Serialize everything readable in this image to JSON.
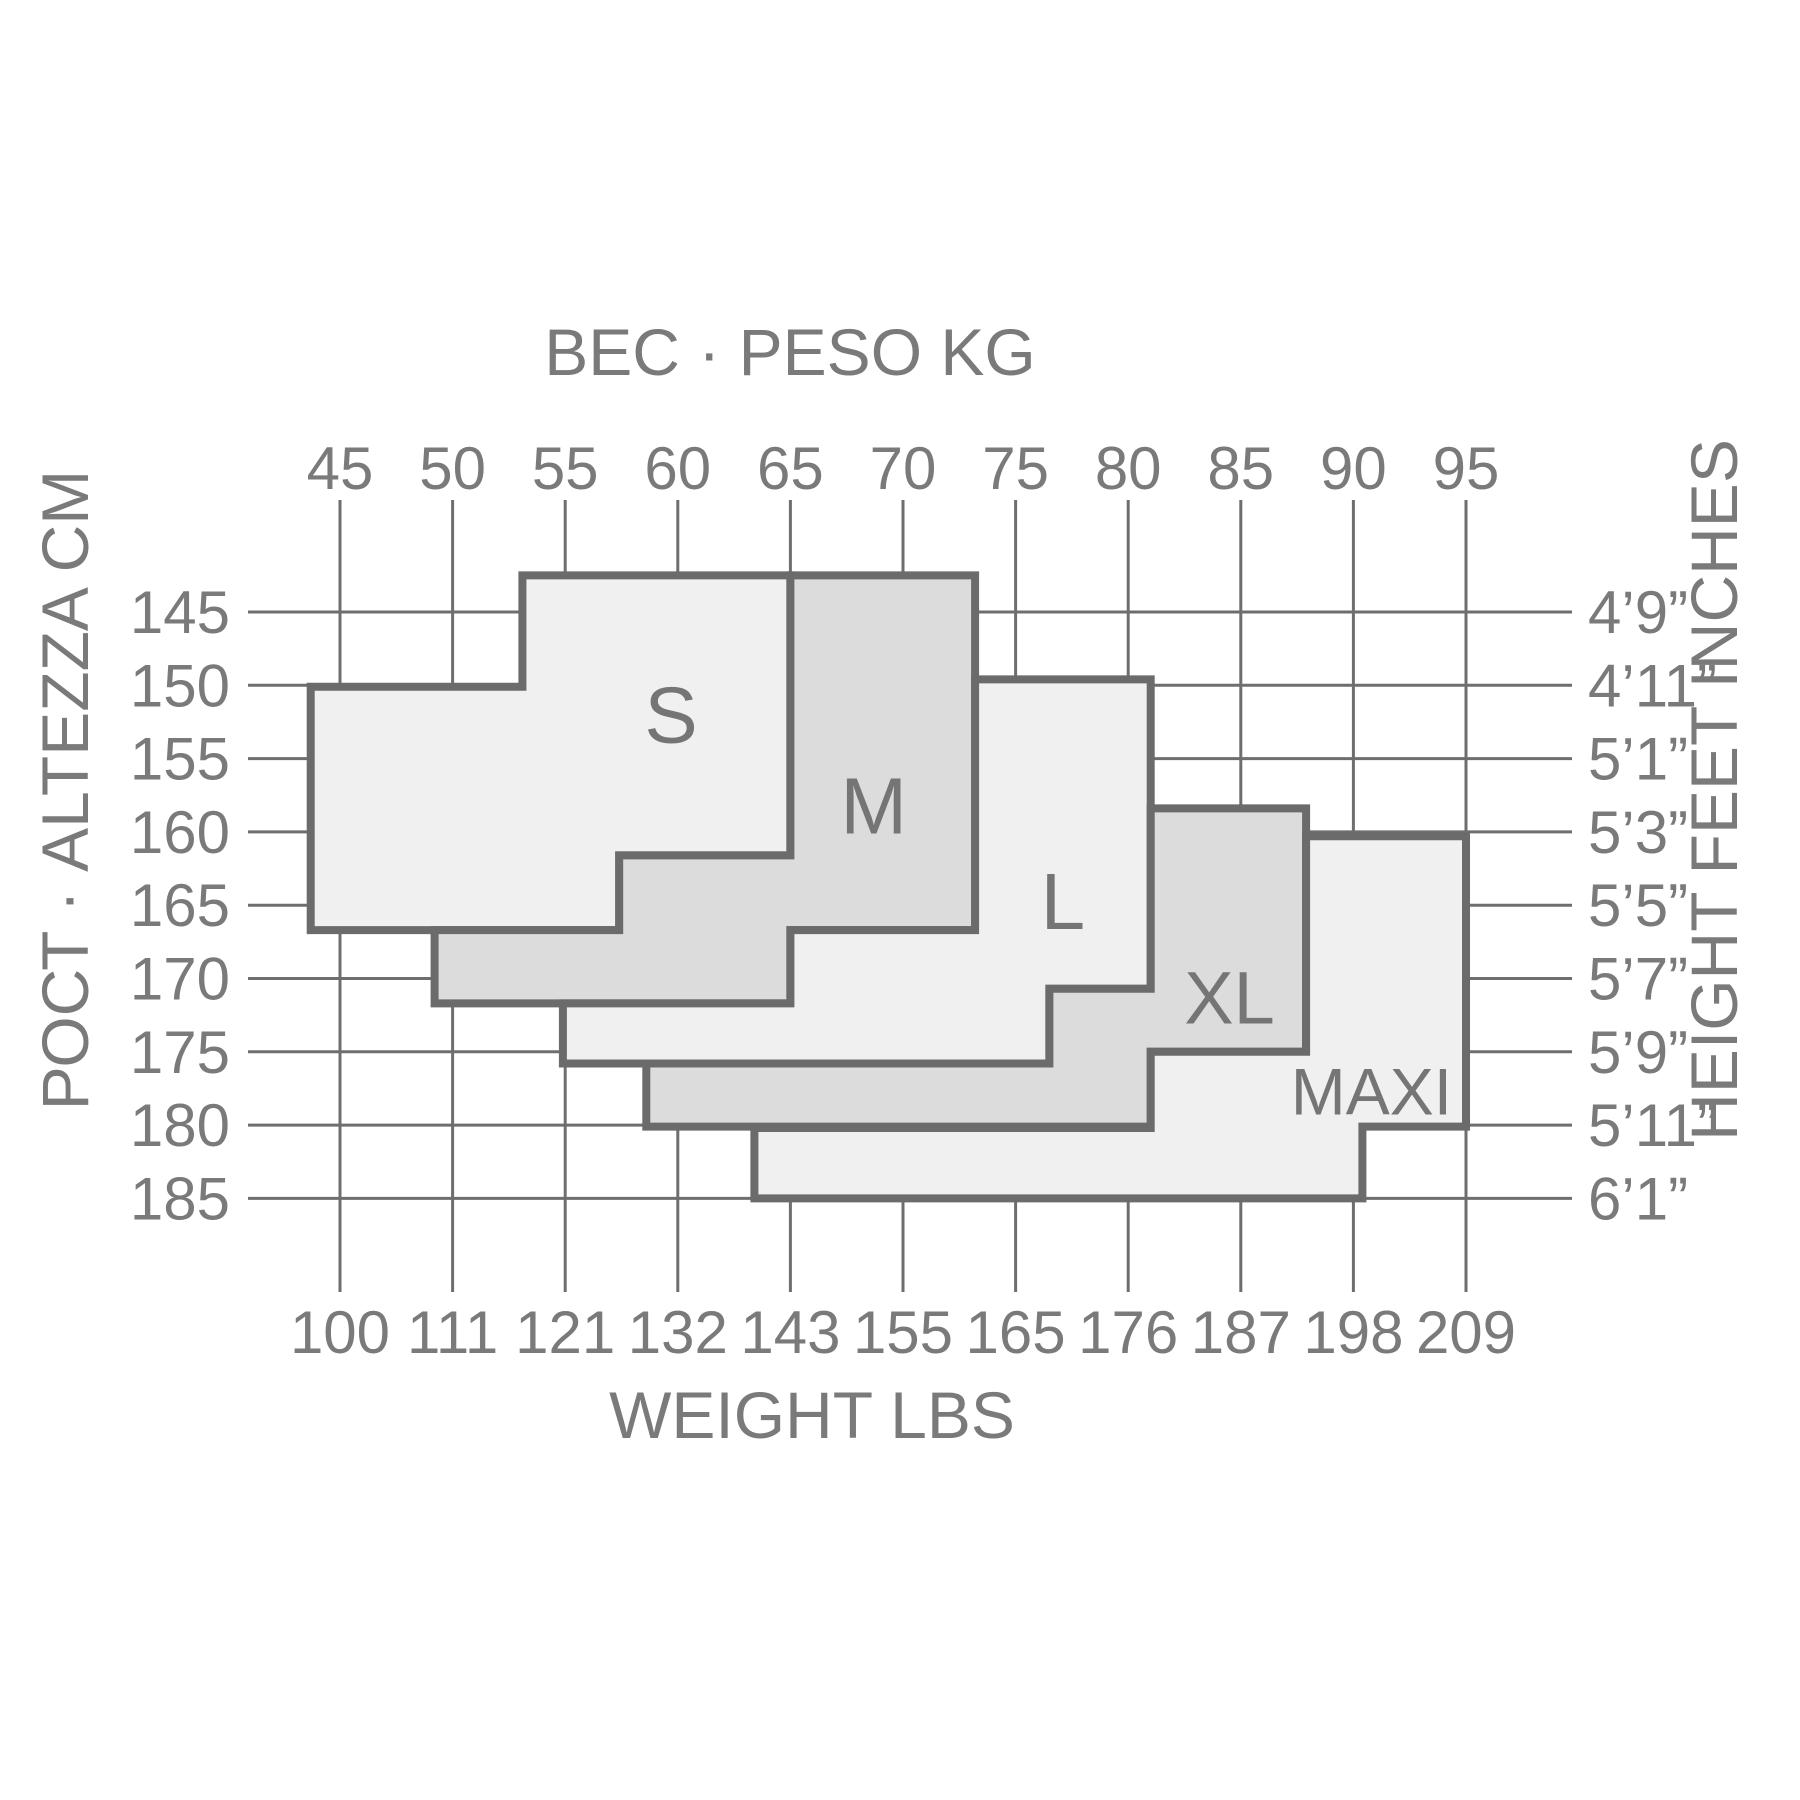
{
  "titles": {
    "top": "ВЕС · PESO KG",
    "bottom": "WEIGHT LBS",
    "left": "РОСТ · ALTEZZA CM",
    "right": "HEIGHT FEET INCHES"
  },
  "colors": {
    "background": "#ffffff",
    "grid_line": "#6e6e6e",
    "region_outline": "#6b6b6b",
    "region_fill_light": "#f0f0f0",
    "region_fill_dark": "#dcdcdc",
    "text": "#7a7a7a",
    "region_label_text": "#757575"
  },
  "chart_data": {
    "type": "area",
    "title": "Size chart: weight vs height size regions (S, M, L, XL, MAXI)",
    "x_axis_top": {
      "label": "ВЕС · PESO KG",
      "ticks": [
        45,
        50,
        55,
        60,
        65,
        70,
        75,
        80,
        85,
        90,
        95
      ]
    },
    "x_axis_bottom": {
      "label": "WEIGHT LBS",
      "ticks": [
        100,
        111,
        121,
        132,
        143,
        155,
        165,
        176,
        187,
        198,
        209
      ]
    },
    "y_axis_left": {
      "label": "РОСТ · ALTEZZA CM",
      "ticks": [
        145,
        150,
        155,
        160,
        165,
        170,
        175,
        180,
        185
      ]
    },
    "y_axis_right": {
      "label": "HEIGHT FEET INCHES",
      "ticks": [
        "4’9”",
        "4’11”",
        "5’1”",
        "5’3”",
        "5’5”",
        "5’7”",
        "5’9”",
        "5’11”",
        "6’1”"
      ]
    },
    "x_range_kg": [
      45,
      95
    ],
    "y_range_cm": [
      145,
      185
    ],
    "grid": true,
    "legend_position": "none",
    "regions": [
      {
        "name": "S",
        "fill": "light",
        "approx_weight_kg": [
          44,
          65
        ],
        "approx_height_cm": [
          142,
          167
        ],
        "label_anchor_kg_cm": [
          59.7,
          152.0
        ],
        "label_font_px": 80,
        "polygon_kg_cm": [
          [
            53.1,
            142.5
          ],
          [
            65,
            142.5
          ],
          [
            65,
            161.6
          ],
          [
            57.4,
            161.6
          ],
          [
            57.4,
            166.7
          ],
          [
            43.7,
            166.7
          ],
          [
            43.7,
            150.1
          ],
          [
            53.1,
            150.1
          ]
        ]
      },
      {
        "name": "M",
        "fill": "dark",
        "approx_weight_kg": [
          49,
          73
        ],
        "approx_height_cm": [
          142,
          172
        ],
        "label_anchor_kg_cm": [
          68.7,
          158.2
        ],
        "label_font_px": 80,
        "polygon_kg_cm": [
          [
            65,
            142.5
          ],
          [
            73.2,
            142.5
          ],
          [
            73.2,
            166.7
          ],
          [
            65,
            166.7
          ],
          [
            65,
            171.7
          ],
          [
            49.2,
            171.7
          ],
          [
            49.2,
            166.7
          ],
          [
            57.4,
            166.7
          ],
          [
            57.4,
            161.6
          ],
          [
            65,
            161.6
          ]
        ]
      },
      {
        "name": "L",
        "fill": "light",
        "approx_weight_kg": [
          55,
          81
        ],
        "approx_height_cm": [
          150,
          176
        ],
        "label_anchor_kg_cm": [
          77.1,
          164.7
        ],
        "label_font_px": 80,
        "polygon_kg_cm": [
          [
            73.2,
            149.6
          ],
          [
            81,
            149.6
          ],
          [
            81,
            170.7
          ],
          [
            76.5,
            170.7
          ],
          [
            76.5,
            175.8
          ],
          [
            54.9,
            175.8
          ],
          [
            54.9,
            171.7
          ],
          [
            65,
            171.7
          ],
          [
            65,
            166.7
          ],
          [
            73.2,
            166.7
          ]
        ]
      },
      {
        "name": "XL",
        "fill": "dark",
        "approx_weight_kg": [
          58,
          88
        ],
        "approx_height_cm": [
          158,
          180
        ],
        "label_anchor_kg_cm": [
          84.5,
          171.3
        ],
        "label_font_px": 74,
        "polygon_kg_cm": [
          [
            81,
            158.4
          ],
          [
            87.9,
            158.4
          ],
          [
            87.9,
            175
          ],
          [
            81,
            175
          ],
          [
            81,
            180.1
          ],
          [
            58.6,
            180.1
          ],
          [
            58.6,
            175.8
          ],
          [
            76.5,
            175.8
          ],
          [
            76.5,
            170.7
          ],
          [
            81,
            170.7
          ]
        ]
      },
      {
        "name": "MAXI",
        "fill": "light",
        "approx_weight_kg": [
          63,
          95
        ],
        "approx_height_cm": [
          160,
          185
        ],
        "label_anchor_kg_cm": [
          90.8,
          177.7
        ],
        "label_font_px": 66,
        "polygon_kg_cm": [
          [
            87.9,
            160.3
          ],
          [
            95,
            160.3
          ],
          [
            95,
            180.1
          ],
          [
            90.4,
            180.1
          ],
          [
            90.4,
            185
          ],
          [
            63.4,
            185
          ],
          [
            63.4,
            180.2
          ],
          [
            81,
            180.2
          ],
          [
            81,
            175
          ],
          [
            87.9,
            175
          ]
        ]
      }
    ]
  }
}
